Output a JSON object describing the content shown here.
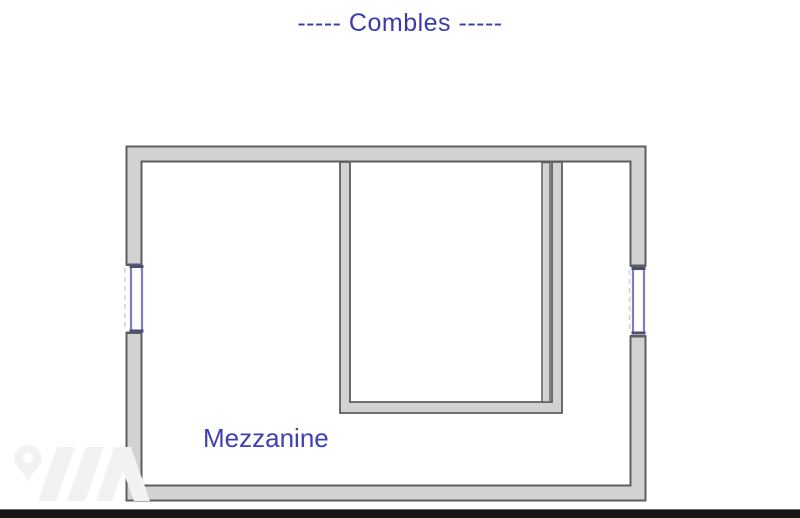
{
  "title": {
    "text": "-----  Combles  -----"
  },
  "plan": {
    "room_label": "Mezzanine",
    "windows": [
      {
        "side": "left"
      },
      {
        "side": "right"
      }
    ],
    "colors": {
      "title_blue": "#3b3bad",
      "label_blue": "#4040b2",
      "wall_fill": "#d2d2d2",
      "wall_stroke": "#5e5e5e",
      "window_frame": "#7f7fbe",
      "window_cap": "#4c4c78",
      "window_dashed": "#d6d6c6"
    }
  },
  "watermark": {
    "icon": "map-pin-zigzag-logo-icon",
    "color": "#f2f2f2"
  },
  "footer": {
    "color": "#161616"
  }
}
